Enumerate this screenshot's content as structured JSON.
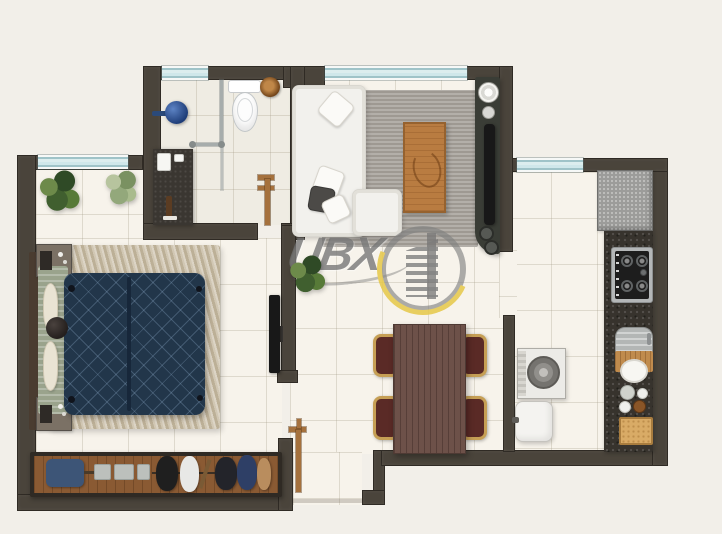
{
  "watermark": {
    "brand": "UBX"
  },
  "colors": {
    "background": "#f2efe9",
    "floor": "#f7f3eb",
    "wall": "#4a443b",
    "window-glass": "#cfe7ea",
    "door-wood": "#a5713d",
    "bed-duvet": "#22364a",
    "bed-rug": "#c9bda6",
    "living-rug": "#a7a29b",
    "sofa": "#f2f1ed",
    "coffee-table": "#b97c41",
    "dining-table": "#6d5149",
    "chair-frame": "#c69f55",
    "chair-seat": "#5a2a26",
    "wardrobe-wood": "#8a5a33",
    "counter-granite": "#37332d",
    "fridge": "#9c9c9a",
    "appliance-white": "#ecebe7",
    "plant-green": "#4e6b3a",
    "logo-gray": "#8a8a8a",
    "logo-accent": "#e7c94d",
    "shower-blue": "#2a4f96"
  },
  "plan": {
    "type": "apartment-floor-plan",
    "rooms": [
      {
        "name": "bathroom",
        "furniture": [
          "shower head",
          "glass shower screen",
          "toilet",
          "vanity with sink",
          "towel ring",
          "door"
        ]
      },
      {
        "name": "bedroom",
        "furniture": [
          "double bed",
          "rug",
          "headboard",
          "nightstand",
          "nightstand",
          "wall tv",
          "wardrobe with clothes",
          "plant",
          "plant"
        ]
      },
      {
        "name": "living room",
        "furniture": [
          "corner sofa",
          "rug",
          "coffee table",
          "tv console with speakers",
          "plant"
        ]
      },
      {
        "name": "dining area",
        "furniture": [
          "dining table",
          "chair",
          "chair",
          "chair",
          "chair",
          "entrance door"
        ]
      },
      {
        "name": "kitchen",
        "furniture": [
          "fridge",
          "granite counter",
          "gas cooktop",
          "sink with cutting board",
          "dishes",
          "wooden tray"
        ]
      },
      {
        "name": "laundry",
        "furniture": [
          "washing machine",
          "laundry tank"
        ]
      }
    ]
  }
}
